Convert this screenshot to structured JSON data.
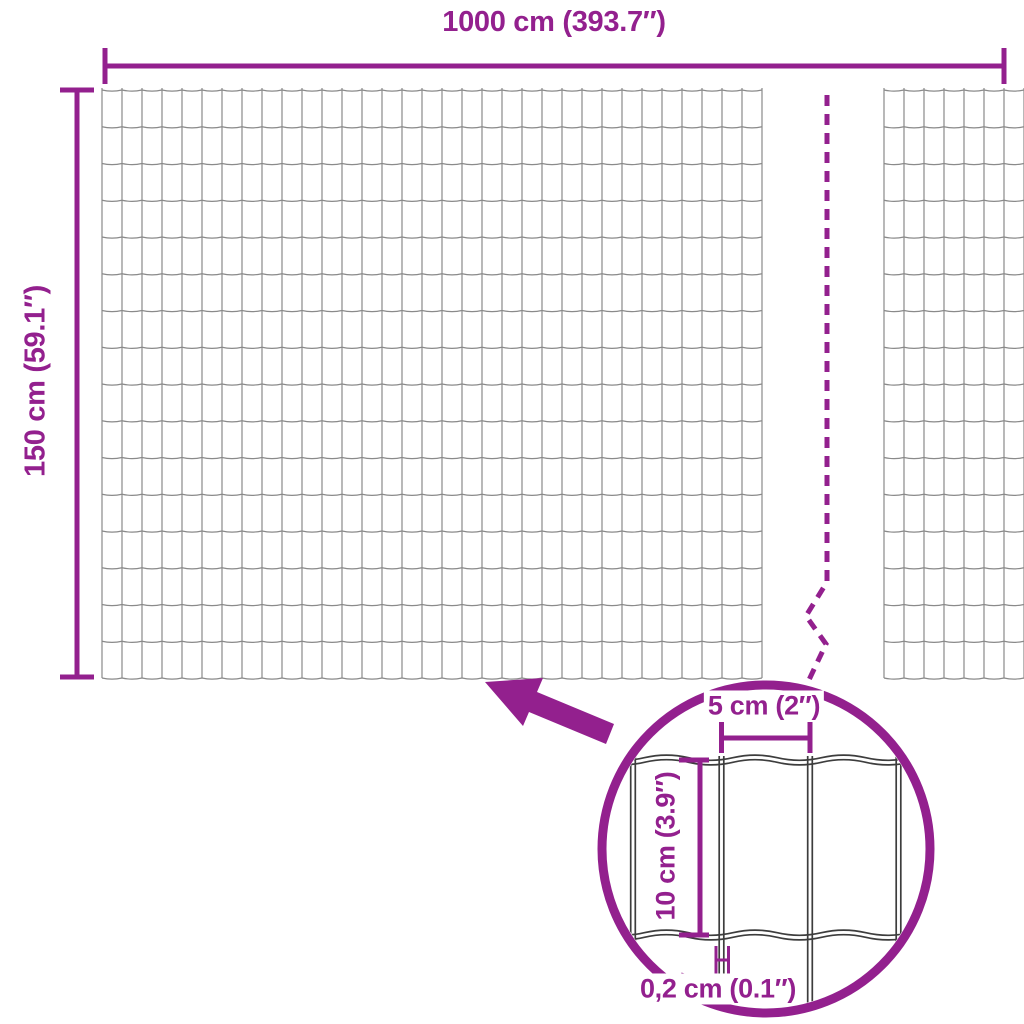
{
  "figure": {
    "type": "dimension-diagram",
    "subject": "wire-mesh-fence"
  },
  "colors": {
    "background": "#FFFFFF",
    "accent": "#93208E",
    "mesh_line": "#8A8A8A",
    "detail_wire_line": "#3D3D3D"
  },
  "dimensions": {
    "total_width": {
      "label": "1000 cm (393.7″)"
    },
    "total_height": {
      "label": "150 cm (59.1″)"
    },
    "mesh_cell_width": {
      "label": "5 cm (2″)"
    },
    "mesh_cell_height": {
      "label": "10 cm (3.9″)"
    },
    "wire_thickness": {
      "label": "0,2 cm (0.1″)"
    }
  },
  "icons": [
    {
      "name": "zoom-arrow-icon"
    },
    {
      "name": "detail-magnifier-circle"
    },
    {
      "name": "break-dashed-line"
    },
    {
      "name": "wire-thickness-marker"
    }
  ]
}
